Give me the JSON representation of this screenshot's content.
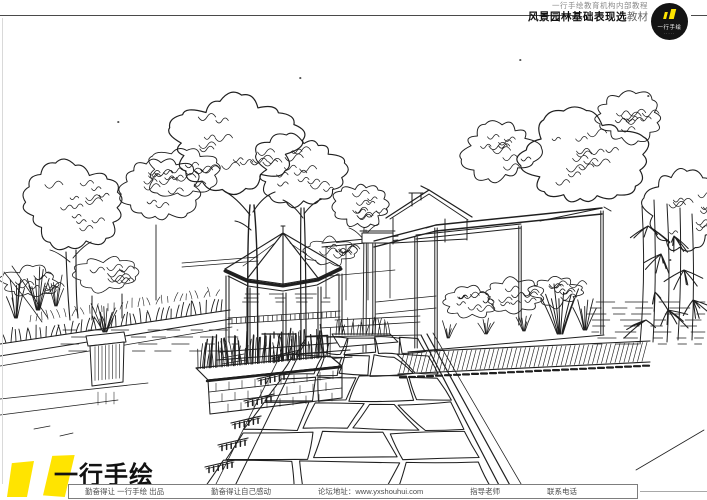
{
  "header": {
    "line1": "一行手绘教育机构内部教程",
    "line2_bold": "风景园林基础表现选",
    "line2_light": "教材",
    "logo": {
      "brand": "一行手绘",
      "dots": "·····"
    }
  },
  "footer": {
    "brand": "一行手绘",
    "bar": {
      "credit": "勤奋得让 一行手绘 出品",
      "slogan": "勤奋得让自己感动",
      "site_label": "论坛地址：",
      "site_url": "www.yxshouhui.com",
      "teacher": "指导老师",
      "phone": "联系电话"
    }
  },
  "artwork": {
    "description": "Hand-drawn pen-and-ink landscape sketch: garden with trees, hexagonal gazebo, pergola frames, gabled house, stone planters with grasses, water rill, wooden deck and flagstone path in perspective"
  },
  "colors": {
    "ink": "#1f1f1f",
    "accent_yellow": "#ffe400",
    "rule_gray": "#4a4a4a"
  }
}
